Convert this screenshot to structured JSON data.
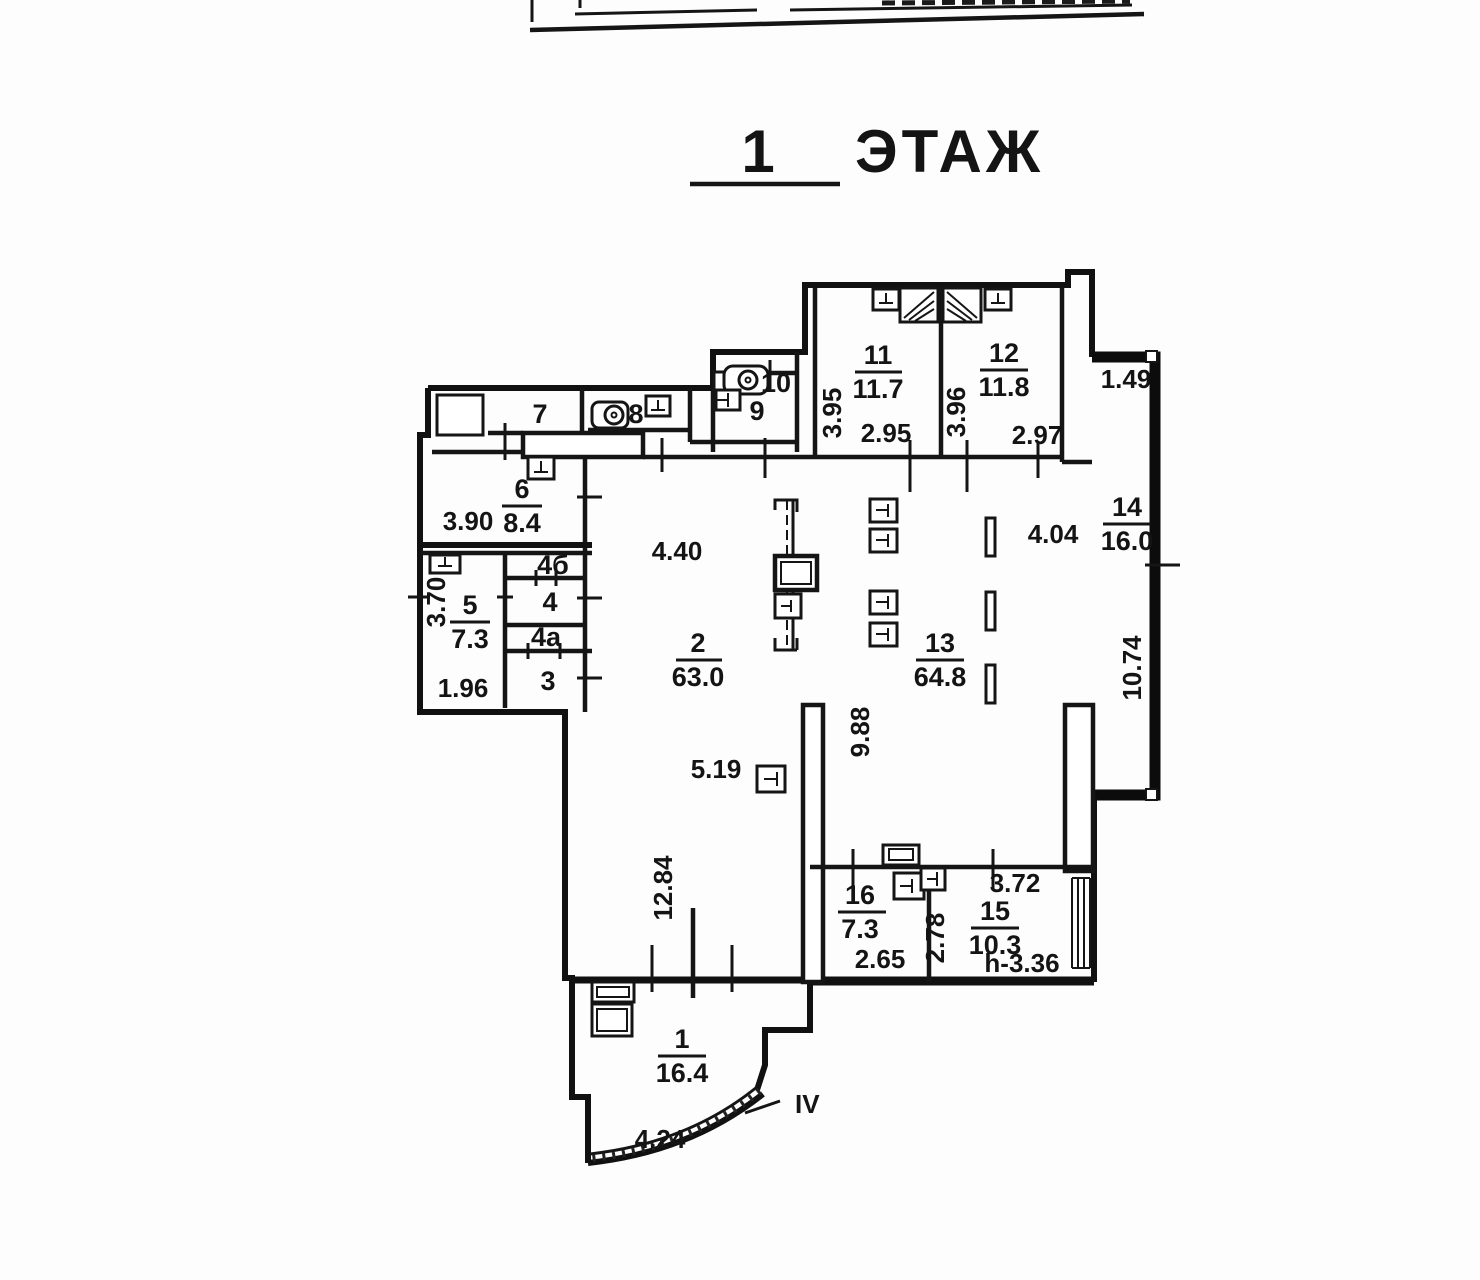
{
  "title": {
    "number": "1",
    "label": "ЭТАЖ"
  },
  "rooms": {
    "r1": {
      "number": "1",
      "area": "16.4"
    },
    "r2": {
      "number": "2",
      "area": "63.0"
    },
    "r3": {
      "number": "3"
    },
    "r4": {
      "number": "4"
    },
    "r4a": {
      "number": "4а"
    },
    "r4b": {
      "number": "4б"
    },
    "r5": {
      "number": "5",
      "area": "7.3"
    },
    "r6": {
      "number": "6",
      "area": "8.4"
    },
    "r7": {
      "number": "7"
    },
    "r8": {
      "number": "8"
    },
    "r9": {
      "number": "9"
    },
    "r10": {
      "number": "10"
    },
    "r11": {
      "number": "11",
      "area": "11.7"
    },
    "r12": {
      "number": "12",
      "area": "11.8"
    },
    "r13": {
      "number": "13",
      "area": "64.8"
    },
    "r14": {
      "number": "14",
      "area": "16.0"
    },
    "r15": {
      "number": "15",
      "area": "10.3"
    },
    "r16": {
      "number": "16",
      "area": "7.3"
    }
  },
  "dimensions": {
    "room6_width": "3.90",
    "room5_depth": "3.70",
    "room5_width": "1.96",
    "hall_upper": "4.40",
    "hall_lower": "5.19",
    "hall_depth": "12.84",
    "vestibule_arc": "4.24",
    "room11_depth": "3.95",
    "room11_width": "2.95",
    "room12_depth": "3.96",
    "room12_width": "2.97",
    "loggia_top": "1.49",
    "hall13_right": "4.04",
    "loggia_depth": "10.74",
    "hall13_depth": "9.88",
    "room16_width": "2.65",
    "room15_left": "2.78",
    "room15_top": "3.72",
    "room15_height_note": "h-3.36",
    "entrance_label": "IV"
  }
}
